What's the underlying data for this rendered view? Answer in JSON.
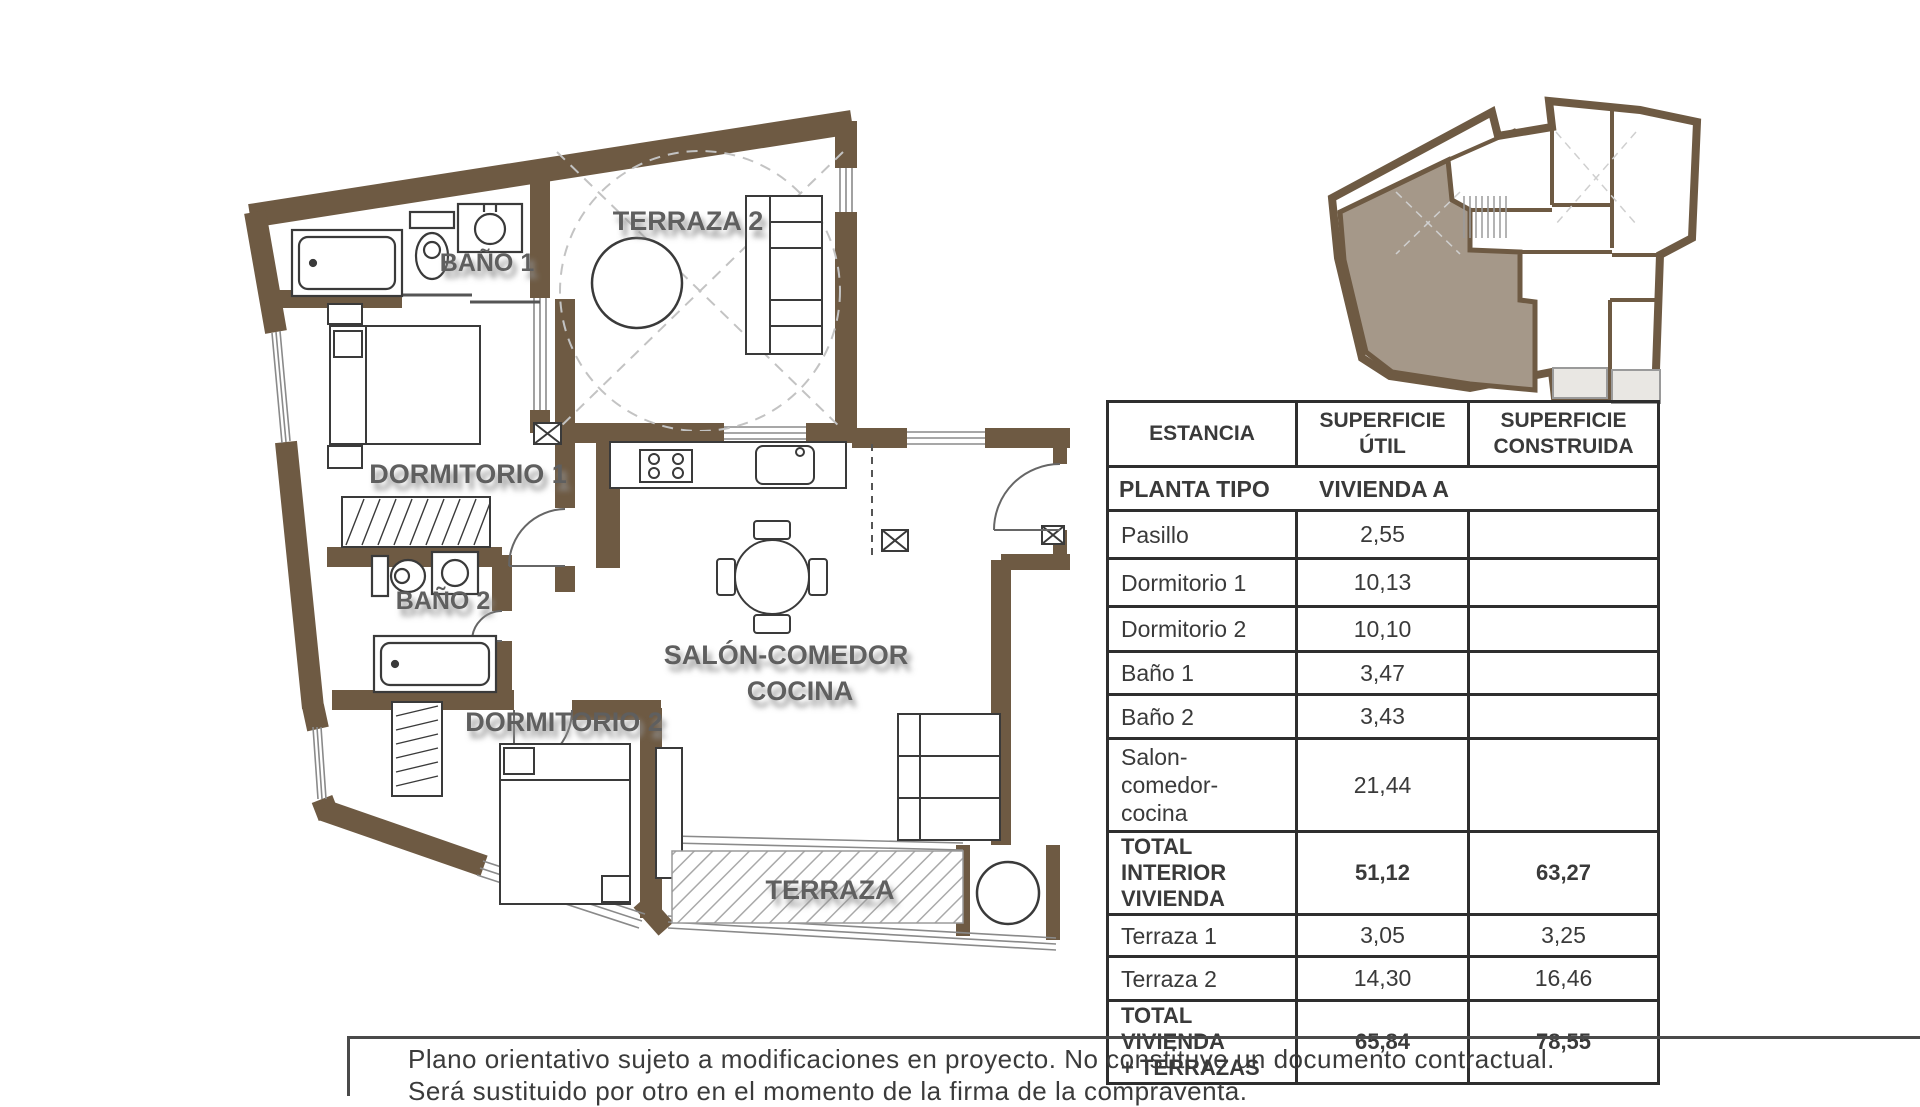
{
  "colors": {
    "wall_brown": "#6e5a43",
    "apartment_highlight": "#a59889",
    "terrace_gray": "#e9e7e3",
    "table_border": "#2e2e2e",
    "text_dark": "#3a3a3a",
    "label_gray": "#5e5e5e"
  },
  "plan": {
    "labels": {
      "terraza2": "TERRAZA 2",
      "bano1": "BAÑO 1",
      "dormitorio1": "DORMITORIO 1",
      "bano2": "BAÑO 2",
      "dormitorio2": "DORMITORIO 2",
      "salon_line1": "SALÓN-COMEDOR",
      "salon_line2": "COCINA",
      "terraza": "TERRAZA"
    }
  },
  "table": {
    "headers": [
      "ESTANCIA",
      "SUPERFICIE ÚTIL",
      "SUPERFICIE CONSTRUIDA"
    ],
    "subheader": {
      "left": "PLANTA TIPO",
      "right": "VIVIENDA A"
    },
    "rows": [
      {
        "name": "Pasillo",
        "util": "2,55",
        "construida": "",
        "bold": false
      },
      {
        "name": "Dormitorio 1",
        "util": "10,13",
        "construida": "",
        "bold": false
      },
      {
        "name": "Dormitorio 2",
        "util": "10,10",
        "construida": "",
        "bold": false
      },
      {
        "name": "Baño 1",
        "util": "3,47",
        "construida": "",
        "bold": false
      },
      {
        "name": "Baño 2",
        "util": "3,43",
        "construida": "",
        "bold": false
      },
      {
        "name": "Salon-\ncomedor-\ncocina",
        "util": "21,44",
        "construida": "",
        "bold": false
      },
      {
        "name": "TOTAL INTERIOR\nVIVIENDA",
        "util": "51,12",
        "construida": "63,27",
        "bold": true
      },
      {
        "name": "Terraza 1",
        "util": "3,05",
        "construida": "3,25",
        "bold": false
      },
      {
        "name": "Terraza 2",
        "util": "14,30",
        "construida": "16,46",
        "bold": false
      },
      {
        "name": "TOTAL VIVIENDA\n+ TERRAZAS",
        "util": "65,84",
        "construida": "78,55",
        "bold": true
      }
    ]
  },
  "disclaimer": {
    "line1": "Plano orientativo sujeto a modificaciones en proyecto. No constituye un documento contractual.",
    "line2": "Será sustituido por otro en el momento de la firma de la compraventa."
  }
}
